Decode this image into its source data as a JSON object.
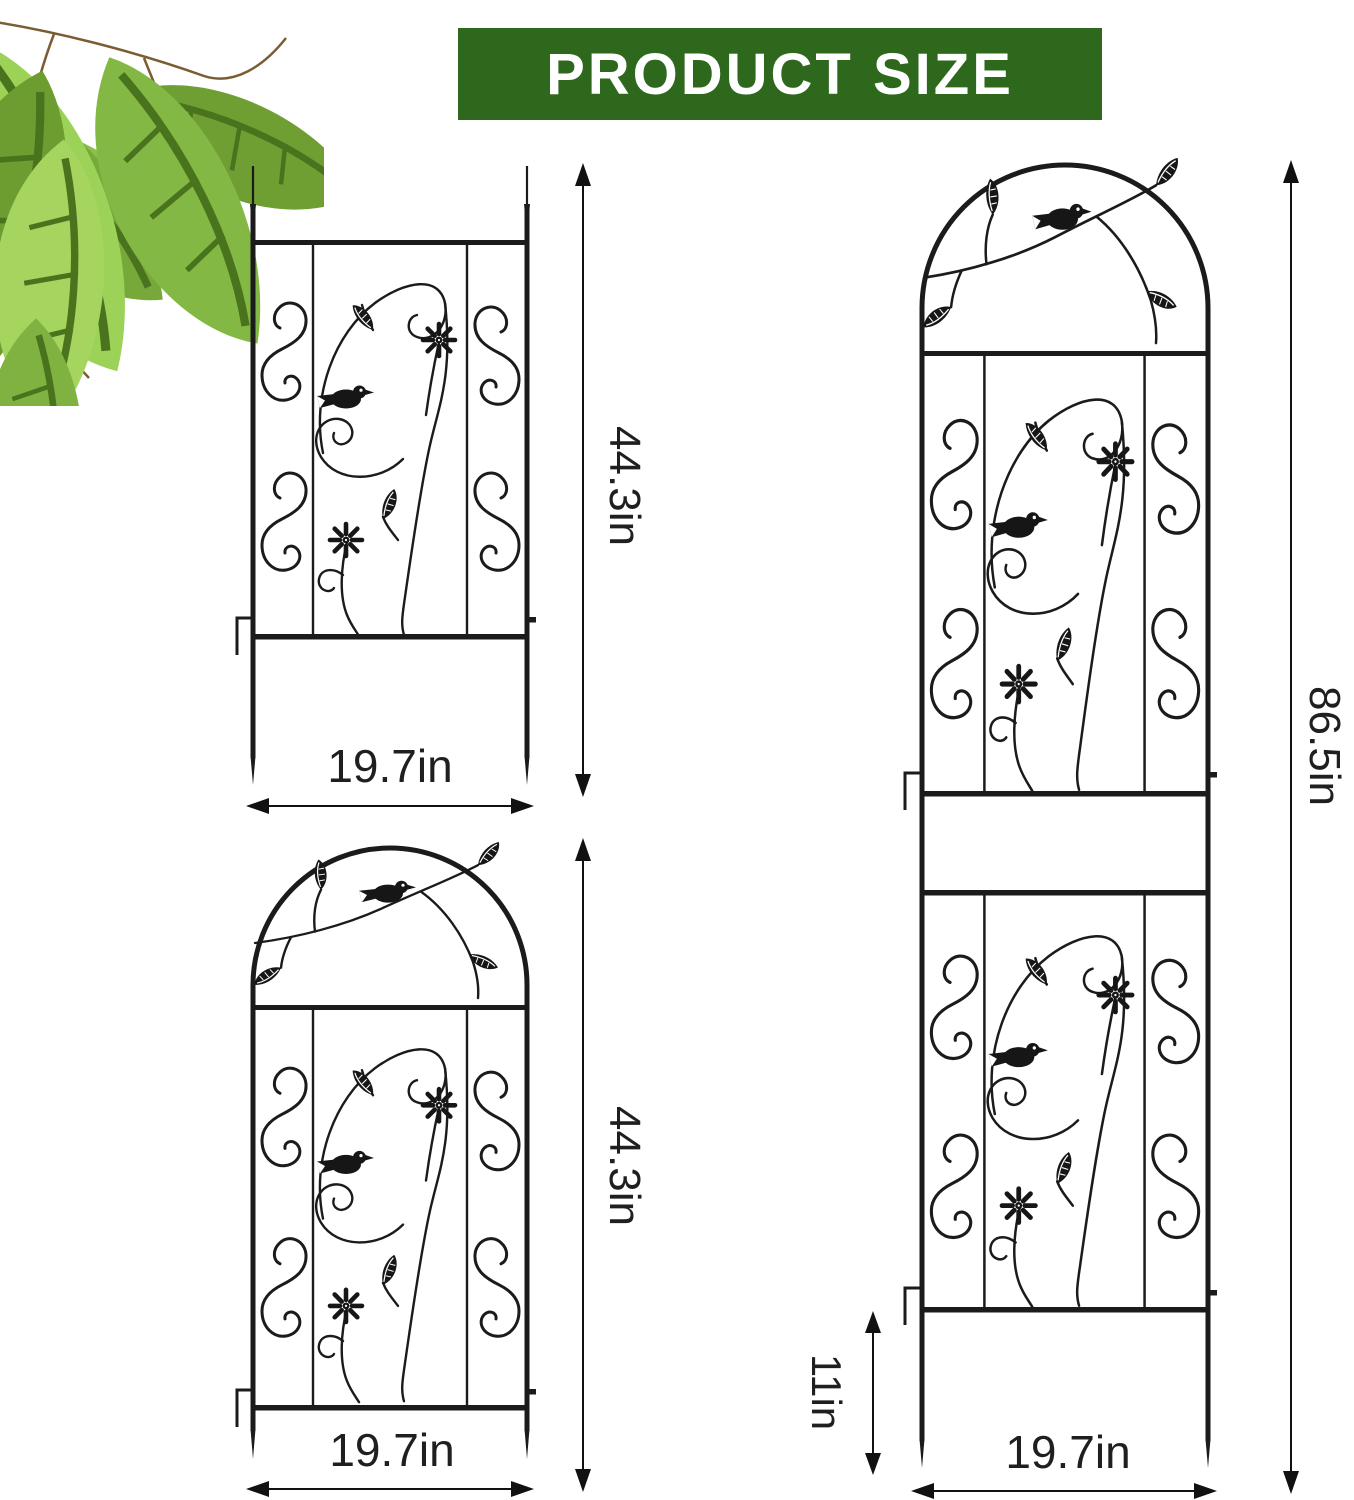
{
  "header": {
    "title": "PRODUCT SIZE",
    "bg_color": "#2e681d",
    "text_color": "#ffffff"
  },
  "dimensions": {
    "trellis_flat": {
      "height": "44.3in",
      "width": "19.7in"
    },
    "trellis_arched": {
      "height": "44.3in",
      "width": "19.7in"
    },
    "trellis_tall": {
      "height": "86.5in",
      "width": "19.7in",
      "stake": "11in"
    }
  },
  "trellises": [
    {
      "name": "flat-top trellis",
      "height": "44.3in",
      "width": "19.7in"
    },
    {
      "name": "arched-top trellis",
      "height": "44.3in",
      "width": "19.7in"
    },
    {
      "name": "tall arched two-panel trellis",
      "height": "86.5in",
      "width": "19.7in",
      "stake": "11in"
    }
  ],
  "icons": {
    "bird": "bird-silhouette",
    "flower": "daisy-flower-silhouette",
    "leaf": "leaf-silhouette",
    "scroll": "s-scroll-ironwork",
    "foliage": "green-leaves-decoration"
  },
  "colors": {
    "banner_green": "#2e681d",
    "iron_line": "#1b1b1b",
    "label_ink": "#1f1f1f",
    "branch_brown": "#7b5c33",
    "leaf_greens": [
      "#8cc04a",
      "#76a93a",
      "#9bd257",
      "#6f9e33",
      "#a5d55f",
      "#84b844"
    ]
  }
}
